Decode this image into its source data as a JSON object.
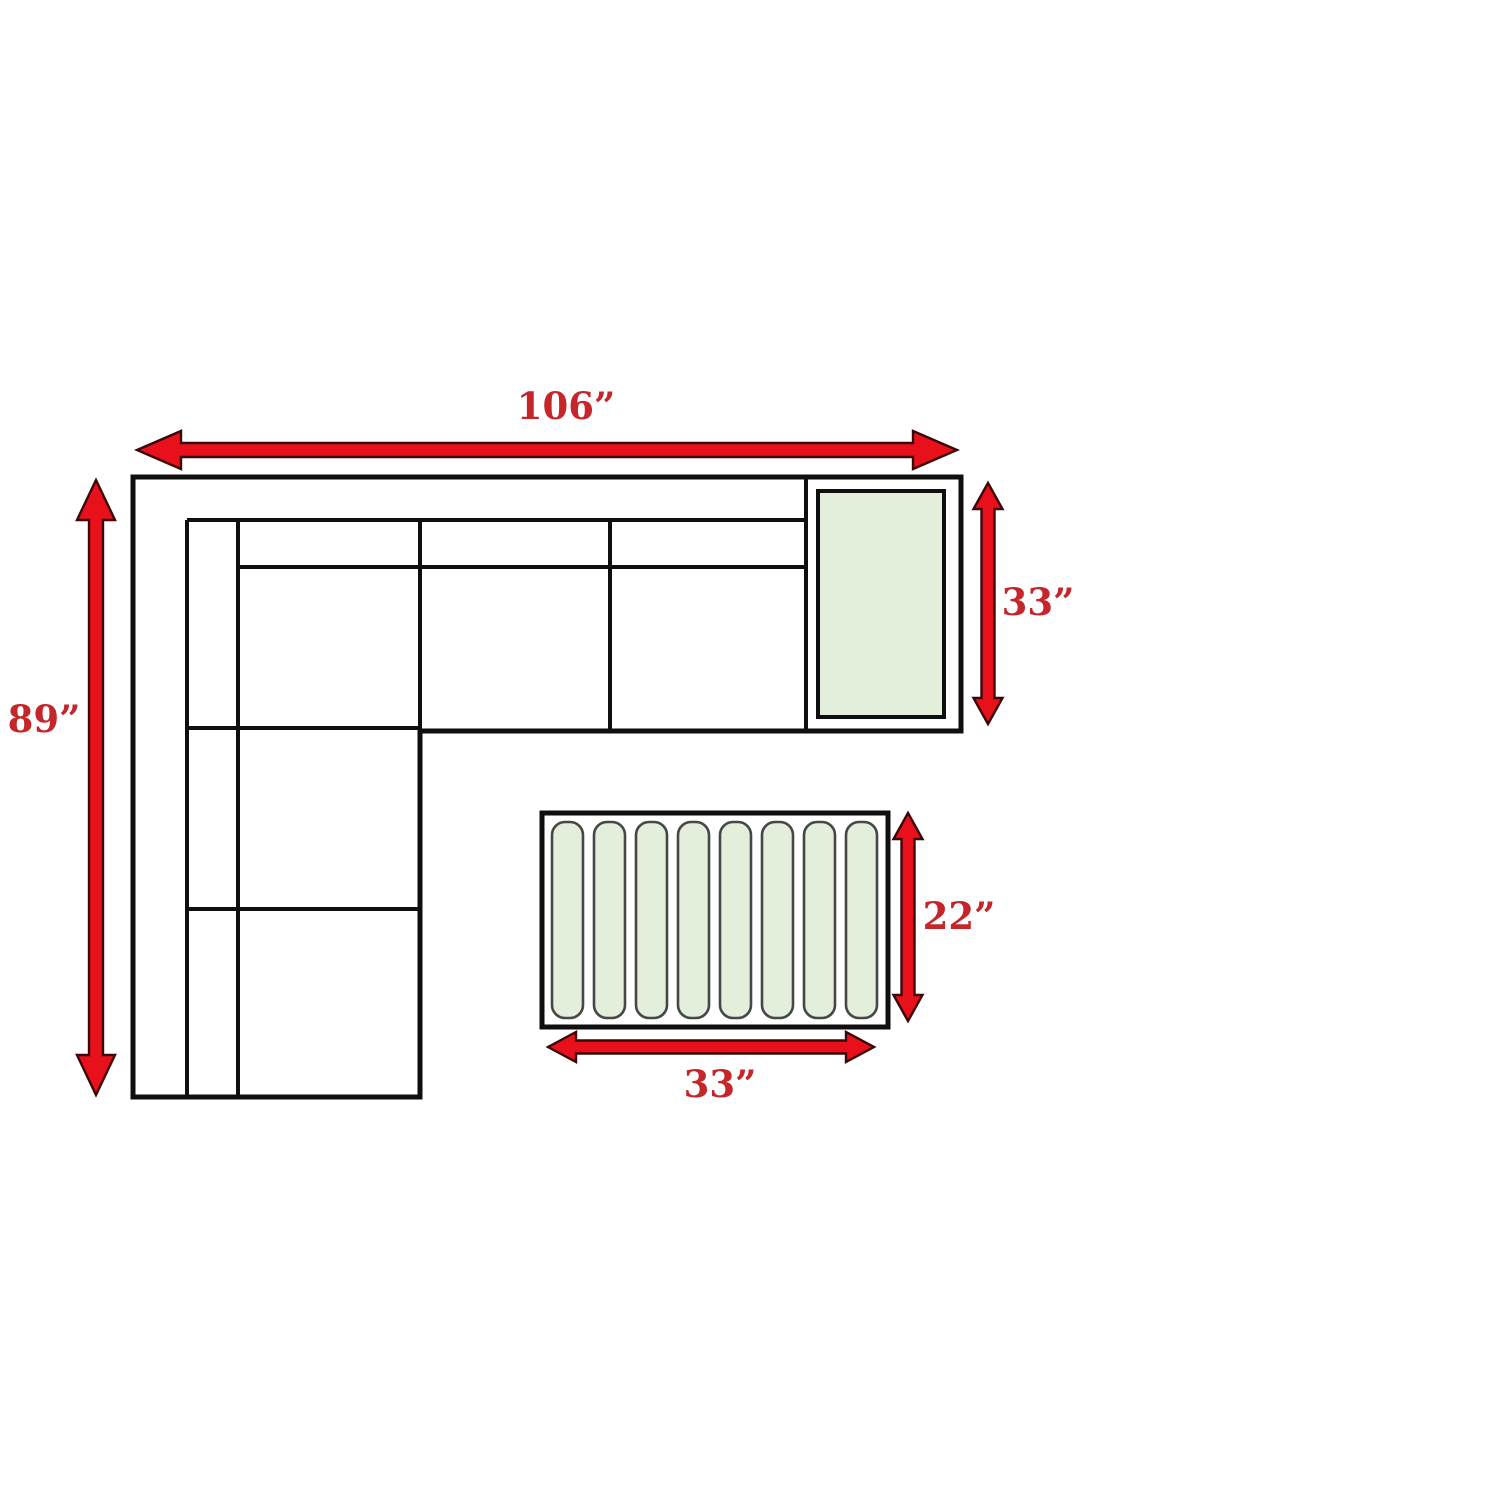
{
  "labels": {
    "sofa_width": "106”",
    "sofa_depth": "89”",
    "corner_table_depth": "33”",
    "coffee_table_depth": "22”",
    "coffee_table_width": "33”"
  },
  "colors": {
    "background": "#ffffff",
    "line_black": "#0f0f0f",
    "arrow_fill": "#e8101b",
    "arrow_outline": "#3c0708",
    "label_text": "#c5262a",
    "table_fill": "#e3eedb",
    "slat_outline": "#474747"
  }
}
